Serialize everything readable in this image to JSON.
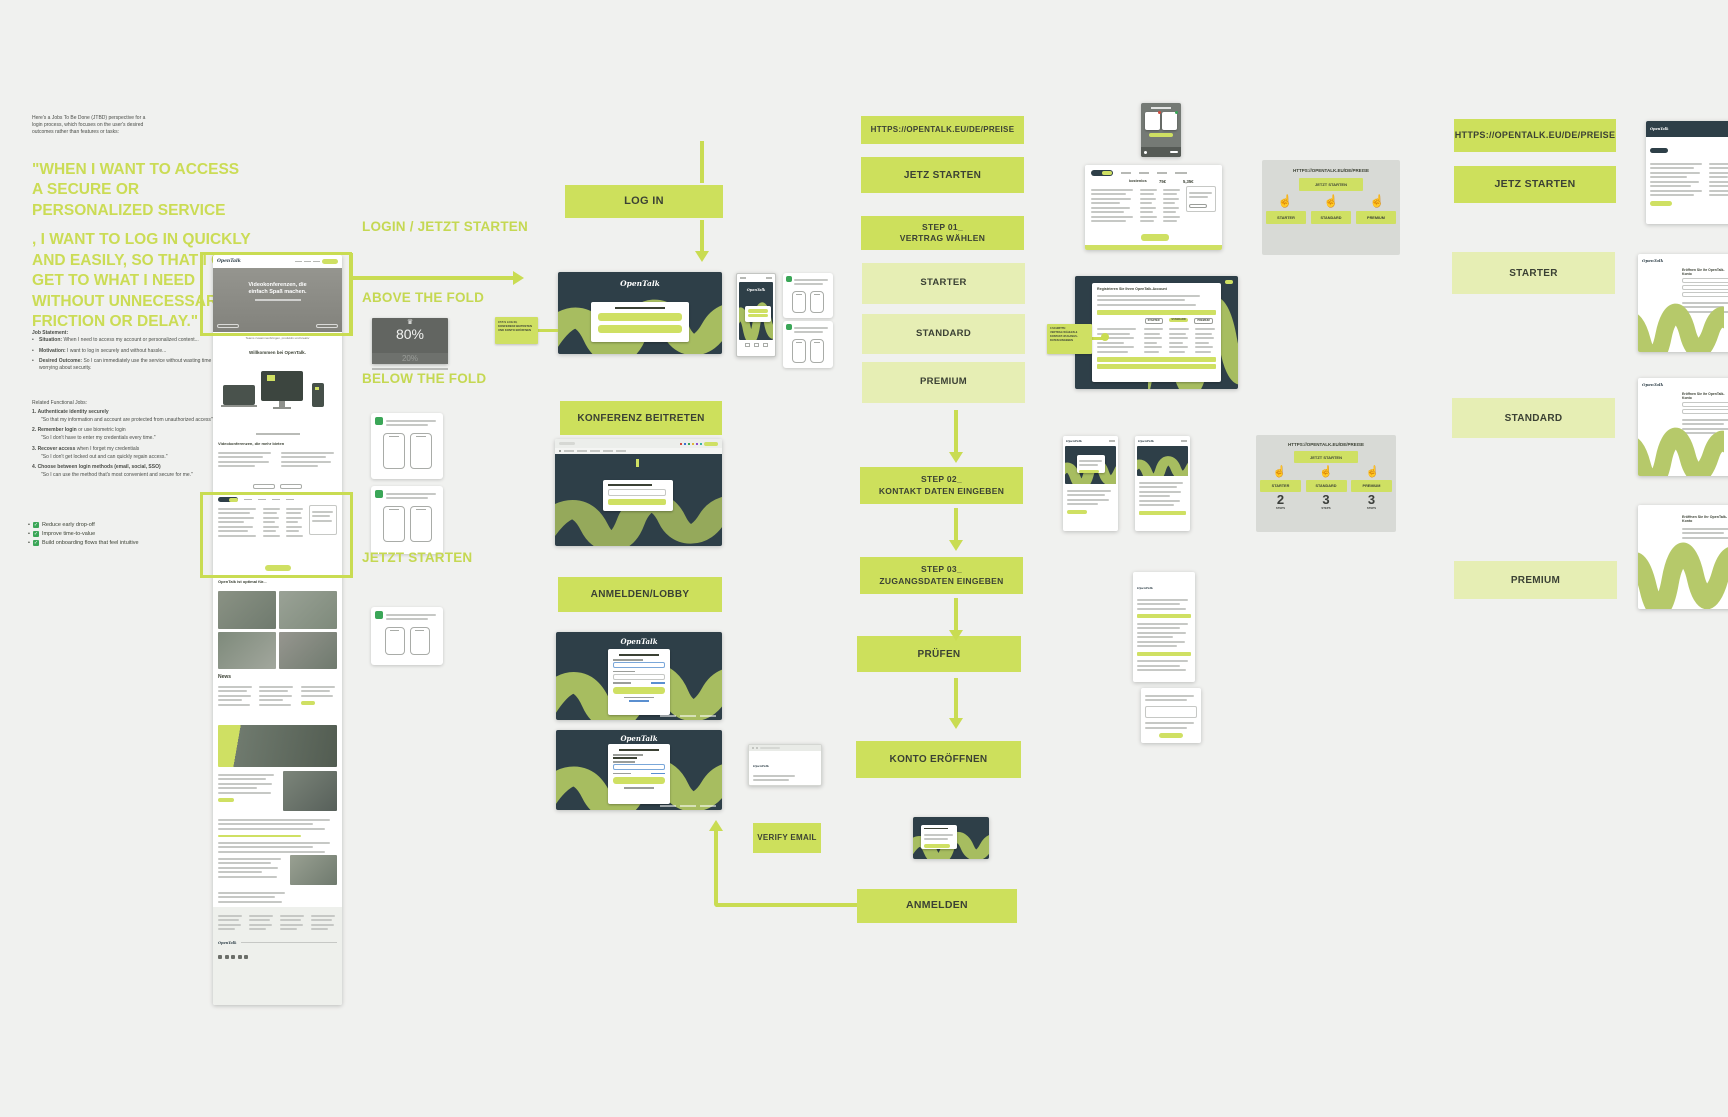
{
  "board": {
    "bg": "#f0f1ef"
  },
  "notes": {
    "intro": "Here's a Jobs To Be Done (JTBD) perspective for a login process, which focuses on the user's desired outcomes rather than features or tasks:",
    "quote_part1": "\"WHEN I WANT TO ACCESS A SECURE OR PERSONALIZED SERVICE",
    "quote_part2": ", I WANT TO LOG IN QUICKLY AND EASILY, SO THAT I CAN GET TO WHAT I NEED WITHOUT UNNECESSARY FRICTION OR DELAY.\"",
    "job_title": "Job Statement:",
    "job_items": [
      {
        "lead": "Situation:",
        "text": " When I need to access my account or personalized content..."
      },
      {
        "lead": "Motivation:",
        "text": " I want to log in securely and without hassle..."
      },
      {
        "lead": "Desired Outcome:",
        "text": " So I can immediately use the service without wasting time or worrying about security."
      }
    ],
    "fj_title": "Related Functional Jobs:",
    "fj_items": [
      {
        "num": "1.",
        "lead": "Authenticate identity securely",
        "rest": "",
        "quote": "\"So that my information and account are protected from unauthorized access\""
      },
      {
        "num": "2.",
        "lead": "Remember login",
        "rest": " or use biometric login",
        "quote": "\"So I don't have to enter my credentials every time.\""
      },
      {
        "num": "3.",
        "lead": "Recover access",
        "rest": " when I forget my credentials",
        "quote": "\"So I don't get locked out and can quickly regain access.\""
      },
      {
        "num": "4.",
        "lead": "Choose between login methods (email, social, SSO)",
        "rest": "",
        "quote": "\"So I can use the method that's most convenient and secure for me.\""
      }
    ],
    "checklist": [
      "Reduce early drop-off",
      "Improve time-to-value",
      "Build onboarding flows that feel intuitive"
    ]
  },
  "labels": {
    "login_jetzt": "LOGIN / JETZT STARTEN",
    "above_fold": "ABOVE THE FOLD",
    "below_fold": "BELOW THE FOLD",
    "jetzt_starten": "JETZT STARTEN"
  },
  "stat": {
    "value": "80%",
    "secondary": "20%",
    "crown": "♛"
  },
  "center": {
    "log_in": "LOG IN",
    "konferenz": "KONFERENZ BEITRETEN",
    "lobby": "ANMELDEN/LOBBY",
    "verify": "VERIFY EMAIL",
    "anmelden": "ANMELDEN"
  },
  "flow": {
    "url": "HTTPS://OPENTALK.EU/DE/PREISE",
    "cta": "JETZ STARTEN",
    "step1_line1": "STEP 01_",
    "step1_line2": "VERTRAG WÄHLEN",
    "plan1": "STARTER",
    "plan2": "STANDARD",
    "plan3": "PREMIUM",
    "step2_line1": "STEP 02_",
    "step2_line2": "KONTAKT DATEN EINGEBEN",
    "step3_line1": "STEP 03_",
    "step3_line2": "ZUGANGSDATEN EINGEBEN",
    "pruefen": "PRÜFEN",
    "konto": "KONTO ERÖFFNEN"
  },
  "right_flow": {
    "url": "HTTPS://OPENTALK.EU/DE/PREISE",
    "cta": "JETZ STARTEN",
    "plan1": "STARTER",
    "plan2": "STANDARD",
    "plan3": "PREMIUM"
  },
  "panels": {
    "url": "HTTPS://OPENTALK.EU/DE/PREISE",
    "cta": "JETZT STARTEN",
    "plan1": "STARTER",
    "plan2": "STANDARD",
    "plan3": "PREMIUM",
    "tap_icon": "☝",
    "steps": [
      {
        "n": "2",
        "label": "STEPS"
      },
      {
        "n": "3",
        "label": "STEPS"
      },
      {
        "n": "3",
        "label": "STEPS"
      }
    ]
  },
  "homepage": {
    "logo": "OpenTalk",
    "hero_line1": "Videokonferenzen, die",
    "hero_line2": "einfach Spaß machen.",
    "hero_sub": "Teams zusammenbringen, produktiv und kreativ",
    "welcome": "Willkommen bei OpenTalk.",
    "features": "Videokonferenzen, die mehr bieten",
    "optimal": "OpenTalk ist optimal für...",
    "news": "News"
  },
  "screens": {
    "logo": "OpenTalk",
    "register_title": "Registrieren Sie Ihren OpenTalk-Account",
    "price_free": "kostenlos",
    "price_mid": "75€",
    "price_high": "5,35€",
    "konto_title": "Eröffnen Sie Ihr OpenTalk-Konto"
  },
  "stickies": {
    "a1": "CTA'S LOG IN,",
    "a2": "KONFERENZ BEITRETEN",
    "a3": "UND KONTO ERÖFFNEN",
    "b1": "3 SCHRITTE:",
    "b2": "VERTRAG WÄHLEN &",
    "b3": "KONTAKT-/ZUGANGS-",
    "b4": "DATEN EINGEBEN"
  }
}
